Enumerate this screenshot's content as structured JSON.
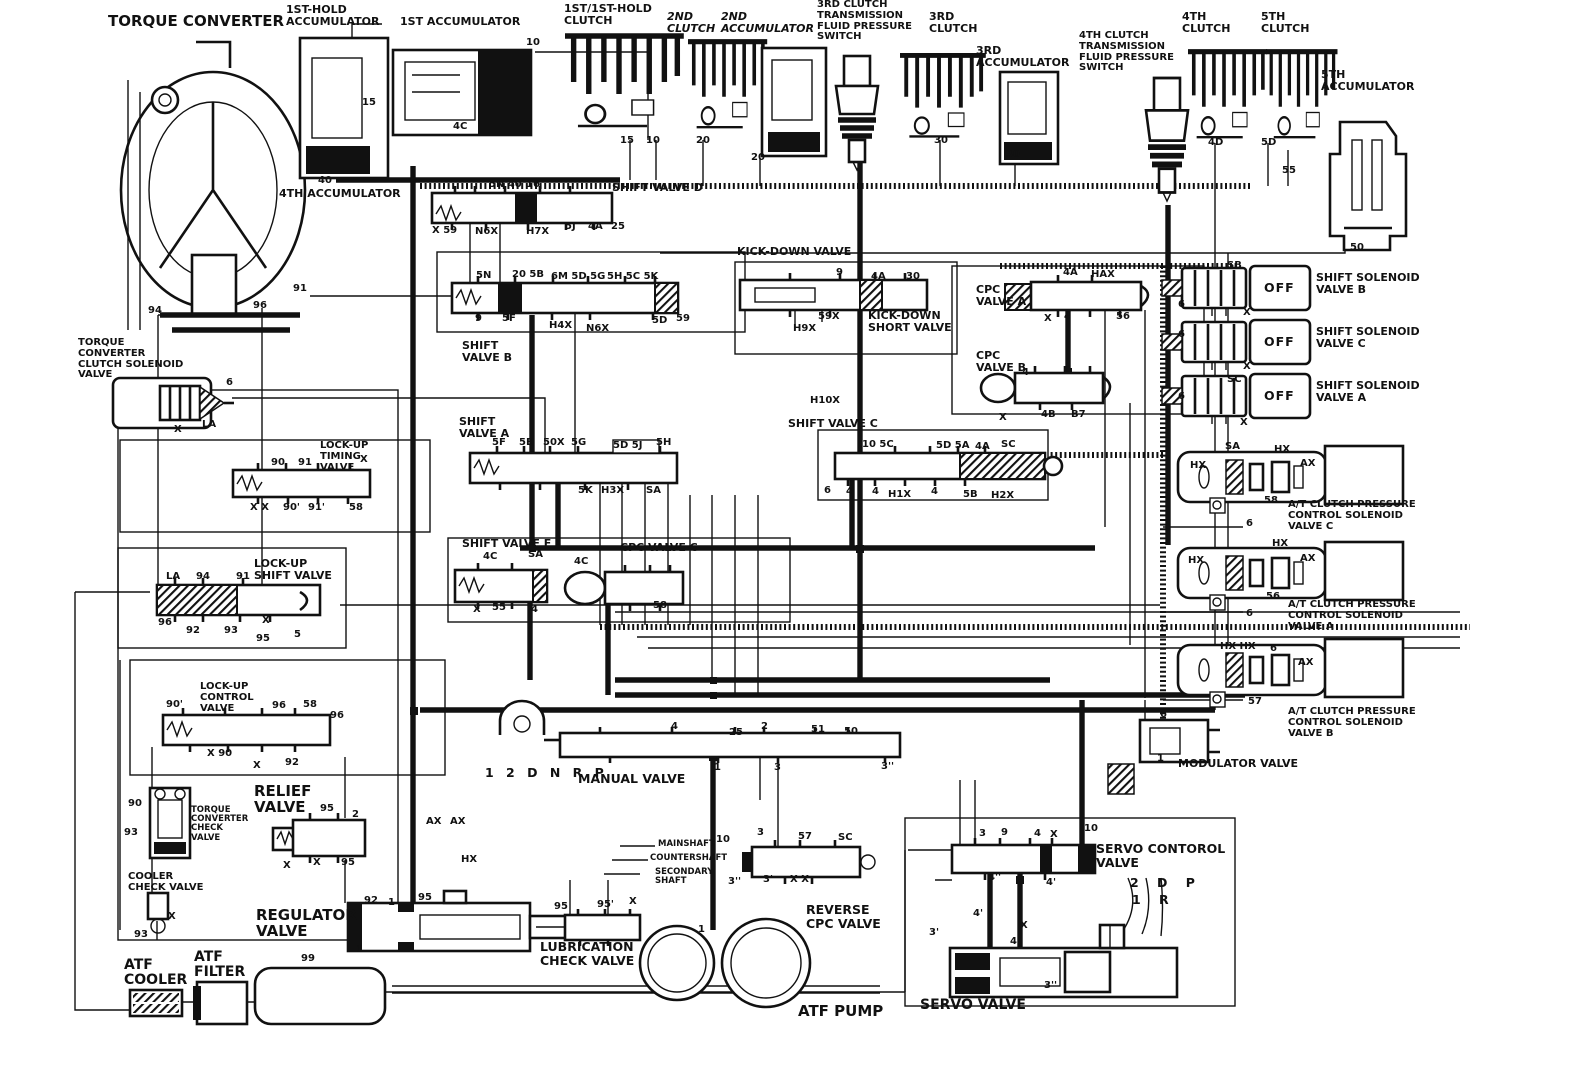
{
  "colors": {
    "ink": "#111111",
    "paper": "#ffffff"
  },
  "labels": {
    "torque_converter": "TORQUE CONVERTER",
    "first_hold_accumulator": "1ST-HOLD\nACCUMULATOR",
    "first_accumulator": "1ST ACCUMULATOR",
    "fourth_accumulator": "4TH ACCUMULATOR",
    "first_first_hold_clutch": "1ST/1ST-HOLD\nCLUTCH",
    "second_clutch": "2ND\nCLUTCH",
    "second_accumulator": "2ND\nACCUMULATOR",
    "third_clutch_switch": "3RD CLUTCH\nTRANSMISSION\nFLUID PRESSURE\nSWITCH",
    "third_clutch": "3RD\nCLUTCH",
    "third_accumulator": "3RD\nACCUMULATOR",
    "fourth_clutch_switch": "4TH CLUTCH\nTRANSMISSION\nFLUID PRESSURE\nSWITCH",
    "fourth_clutch": "4TH\nCLUTCH",
    "fifth_clutch": "5TH\nCLUTCH",
    "fifth_accumulator": "5TH\nACCUMULATOR",
    "shift_valve_d": "SHIFT VALVE D",
    "kick_down_valve": "KICK-DOWN VALVE",
    "kick_down_short_valve": "KICK-DOWN\nSHORT VALVE",
    "cpc_valve_a": "CPC\nVALVE A",
    "cpc_valve_b": "CPC\nVALVE B",
    "cpc_valve_c": "CPC VALVE C",
    "shift_valve_b": "SHIFT\nVALVE B",
    "shift_valve_a": "SHIFT\nVALVE A",
    "shift_valve_c": "SHIFT VALVE C",
    "shift_valve_e": "SHIFT VALVE E",
    "shift_solenoid_b": "SHIFT SOLENOID\nVALVE B",
    "shift_solenoid_c": "SHIFT SOLENOID\nVALVE C",
    "shift_solenoid_a": "SHIFT SOLENOID\nVALVE A",
    "at_cpcs_c": "A/T CLUTCH PRESSURE\nCONTROL SOLENOID\nVALVE C",
    "at_cpcs_a": "A/T CLUTCH PRESSURE\nCONTROL SOLENOID\nVALVE A",
    "at_cpcs_b": "A/T CLUTCH PRESSURE\nCONTROL SOLENOID\nVALVE B",
    "modulator_valve": "MODULATOR VALVE",
    "tcc_solenoid_valve": "TORQUE\nCONVERTER\nCLUTCH SOLENOID\nVALVE",
    "lockup_timing_valve": "LOCK-UP\nTIMING\nVALVE",
    "lockup_shift_valve": "LOCK-UP\nSHIFT VALVE",
    "lockup_control_valve": "LOCK-UP\nCONTROL\nVALVE",
    "tc_check_valve": "TORQUE\nCONVERTER\nCHECK\nVALVE",
    "cooler_check_valve": "COOLER\nCHECK VALVE",
    "relief_valve": "RELIEF\nVALVE",
    "regulator_valve": "REGULATOR\nVALVE",
    "atf_cooler": "ATF\nCOOLER",
    "atf_filter": "ATF\nFILTER",
    "manual_valve": "MANUAL VALVE",
    "manual_positions": "1 2 D N R   P",
    "mainshaft": "MAINSHAFT",
    "countershaft": "COUNTERSHAFT",
    "secondary_shaft": "SECONDARY\nSHAFT",
    "lubrication_check_valve": "LUBRICATION\nCHECK VALVE",
    "atf_pump": "ATF PUMP",
    "reverse_cpc_valve": "REVERSE\nCPC VALVE",
    "servo_control_valve": "SERVO CONTOROL\nVALVE",
    "servo_valve": "SERVO VALVE",
    "servo_pos_top": "2 D  P",
    "servo_pos_bottom": "1      R"
  },
  "ports": [
    {
      "t": "10",
      "x": 526,
      "y": 38
    },
    {
      "t": "15",
      "x": 362,
      "y": 98
    },
    {
      "t": "40",
      "x": 318,
      "y": 176
    },
    {
      "t": "4C",
      "x": 453,
      "y": 122
    },
    {
      "t": "15",
      "x": 620,
      "y": 136
    },
    {
      "t": "10",
      "x": 646,
      "y": 136
    },
    {
      "t": "20",
      "x": 696,
      "y": 136
    },
    {
      "t": "20",
      "x": 751,
      "y": 153
    },
    {
      "t": "30",
      "x": 934,
      "y": 136
    },
    {
      "t": "30",
      "x": 1006,
      "y": 150
    },
    {
      "t": "4D",
      "x": 1208,
      "y": 138
    },
    {
      "t": "5D",
      "x": 1261,
      "y": 138
    },
    {
      "t": "55",
      "x": 1282,
      "y": 166
    },
    {
      "t": "50",
      "x": 1350,
      "y": 243
    },
    {
      "t": "5N 40",
      "x": 489,
      "y": 180
    },
    {
      "t": "16",
      "x": 526,
      "y": 180
    },
    {
      "t": "X 59",
      "x": 432,
      "y": 226
    },
    {
      "t": "N6X",
      "x": 475,
      "y": 227
    },
    {
      "t": "H7X",
      "x": 526,
      "y": 227
    },
    {
      "t": "5J",
      "x": 565,
      "y": 222
    },
    {
      "t": "4A",
      "x": 588,
      "y": 222
    },
    {
      "t": "25",
      "x": 611,
      "y": 222
    },
    {
      "t": "5N",
      "x": 476,
      "y": 271
    },
    {
      "t": "20 5B",
      "x": 512,
      "y": 270
    },
    {
      "t": "6M 5D 5G",
      "x": 551,
      "y": 272
    },
    {
      "t": "5H 5C 5K",
      "x": 607,
      "y": 272
    },
    {
      "t": "9",
      "x": 475,
      "y": 314
    },
    {
      "t": "5F",
      "x": 502,
      "y": 314
    },
    {
      "t": "H4X",
      "x": 549,
      "y": 321
    },
    {
      "t": "N6X",
      "x": 586,
      "y": 324
    },
    {
      "t": "5D",
      "x": 652,
      "y": 316
    },
    {
      "t": "59",
      "x": 676,
      "y": 314
    },
    {
      "t": "5F",
      "x": 492,
      "y": 438
    },
    {
      "t": "5E",
      "x": 519,
      "y": 438
    },
    {
      "t": "50X",
      "x": 543,
      "y": 438
    },
    {
      "t": "5G",
      "x": 571,
      "y": 438
    },
    {
      "t": "5D 5J",
      "x": 613,
      "y": 441
    },
    {
      "t": "5H",
      "x": 656,
      "y": 438
    },
    {
      "t": "5K",
      "x": 578,
      "y": 486
    },
    {
      "t": "H3X",
      "x": 601,
      "y": 486
    },
    {
      "t": "SA",
      "x": 646,
      "y": 486
    },
    {
      "t": "9",
      "x": 836,
      "y": 268
    },
    {
      "t": "4A",
      "x": 871,
      "y": 272
    },
    {
      "t": "30",
      "x": 906,
      "y": 272
    },
    {
      "t": "59X",
      "x": 818,
      "y": 312
    },
    {
      "t": "H9X",
      "x": 793,
      "y": 324
    },
    {
      "t": "H10X",
      "x": 810,
      "y": 396
    },
    {
      "t": "4A",
      "x": 1063,
      "y": 268
    },
    {
      "t": "HAX",
      "x": 1091,
      "y": 270
    },
    {
      "t": "X",
      "x": 1044,
      "y": 314
    },
    {
      "t": "4",
      "x": 1064,
      "y": 312
    },
    {
      "t": "56",
      "x": 1116,
      "y": 312
    },
    {
      "t": "4",
      "x": 1022,
      "y": 368
    },
    {
      "t": "X",
      "x": 999,
      "y": 413
    },
    {
      "t": "4B",
      "x": 1041,
      "y": 410
    },
    {
      "t": "B7",
      "x": 1071,
      "y": 410
    },
    {
      "t": "10 5C",
      "x": 862,
      "y": 440
    },
    {
      "t": "5D 5A",
      "x": 936,
      "y": 441
    },
    {
      "t": "4A",
      "x": 975,
      "y": 442
    },
    {
      "t": "SC",
      "x": 1001,
      "y": 440
    },
    {
      "t": "6",
      "x": 824,
      "y": 486
    },
    {
      "t": "4",
      "x": 846,
      "y": 487
    },
    {
      "t": "4",
      "x": 872,
      "y": 487
    },
    {
      "t": "H1X",
      "x": 888,
      "y": 490
    },
    {
      "t": "4",
      "x": 931,
      "y": 487
    },
    {
      "t": "5B",
      "x": 963,
      "y": 490
    },
    {
      "t": "H2X",
      "x": 991,
      "y": 491
    },
    {
      "t": "4C",
      "x": 483,
      "y": 552
    },
    {
      "t": "SA",
      "x": 528,
      "y": 550
    },
    {
      "t": "X",
      "x": 473,
      "y": 605
    },
    {
      "t": "55",
      "x": 492,
      "y": 603
    },
    {
      "t": "4",
      "x": 531,
      "y": 605
    },
    {
      "t": "4C",
      "x": 574,
      "y": 557
    },
    {
      "t": "58",
      "x": 653,
      "y": 601
    },
    {
      "t": "SB",
      "x": 1227,
      "y": 261
    },
    {
      "t": "6",
      "x": 1178,
      "y": 300
    },
    {
      "t": "X",
      "x": 1243,
      "y": 308
    },
    {
      "t": "OFF",
      "x": 1264,
      "y": 282,
      "c": "off"
    },
    {
      "t": "OFF",
      "x": 1264,
      "y": 336,
      "c": "off"
    },
    {
      "t": "OFF",
      "x": 1264,
      "y": 390,
      "c": "off"
    },
    {
      "t": "6",
      "x": 1178,
      "y": 330
    },
    {
      "t": "X",
      "x": 1243,
      "y": 362
    },
    {
      "t": "SC",
      "x": 1227,
      "y": 375
    },
    {
      "t": "6",
      "x": 1178,
      "y": 392
    },
    {
      "t": "X",
      "x": 1240,
      "y": 418
    },
    {
      "t": "SA",
      "x": 1225,
      "y": 442
    },
    {
      "t": "HX",
      "x": 1274,
      "y": 445
    },
    {
      "t": "HX",
      "x": 1190,
      "y": 461
    },
    {
      "t": "AX",
      "x": 1300,
      "y": 459
    },
    {
      "t": "58",
      "x": 1264,
      "y": 496
    },
    {
      "t": "6",
      "x": 1246,
      "y": 519
    },
    {
      "t": "HX",
      "x": 1272,
      "y": 539
    },
    {
      "t": "HX",
      "x": 1188,
      "y": 556
    },
    {
      "t": "AX",
      "x": 1300,
      "y": 554
    },
    {
      "t": "56",
      "x": 1266,
      "y": 592
    },
    {
      "t": "6",
      "x": 1246,
      "y": 609
    },
    {
      "t": "HX HX",
      "x": 1220,
      "y": 642
    },
    {
      "t": "6",
      "x": 1270,
      "y": 644
    },
    {
      "t": "AX",
      "x": 1298,
      "y": 658
    },
    {
      "t": "57",
      "x": 1248,
      "y": 697
    },
    {
      "t": "6",
      "x": 1160,
      "y": 710
    },
    {
      "t": "1",
      "x": 1157,
      "y": 754
    },
    {
      "t": "94",
      "x": 148,
      "y": 306
    },
    {
      "t": "96",
      "x": 253,
      "y": 301
    },
    {
      "t": "91",
      "x": 293,
      "y": 284
    },
    {
      "t": "6",
      "x": 226,
      "y": 378
    },
    {
      "t": "X",
      "x": 174,
      "y": 425
    },
    {
      "t": "LA",
      "x": 202,
      "y": 420
    },
    {
      "t": "90",
      "x": 271,
      "y": 458
    },
    {
      "t": "91",
      "x": 298,
      "y": 458
    },
    {
      "t": "X",
      "x": 360,
      "y": 455
    },
    {
      "t": "X X",
      "x": 250,
      "y": 503
    },
    {
      "t": "90'",
      "x": 283,
      "y": 503
    },
    {
      "t": "91'",
      "x": 308,
      "y": 503
    },
    {
      "t": "58",
      "x": 349,
      "y": 503
    },
    {
      "t": "LA",
      "x": 166,
      "y": 572
    },
    {
      "t": "94",
      "x": 196,
      "y": 572
    },
    {
      "t": "91",
      "x": 236,
      "y": 572
    },
    {
      "t": "96",
      "x": 158,
      "y": 618
    },
    {
      "t": "92",
      "x": 186,
      "y": 626
    },
    {
      "t": "93",
      "x": 224,
      "y": 626
    },
    {
      "t": "X",
      "x": 262,
      "y": 616
    },
    {
      "t": "95",
      "x": 256,
      "y": 634
    },
    {
      "t": "5",
      "x": 294,
      "y": 630
    },
    {
      "t": "90'",
      "x": 166,
      "y": 700
    },
    {
      "t": "96",
      "x": 272,
      "y": 701
    },
    {
      "t": "58",
      "x": 303,
      "y": 700
    },
    {
      "t": "96",
      "x": 330,
      "y": 711
    },
    {
      "t": "X 90",
      "x": 207,
      "y": 749
    },
    {
      "t": "X",
      "x": 253,
      "y": 761
    },
    {
      "t": "92",
      "x": 285,
      "y": 758
    },
    {
      "t": "90",
      "x": 128,
      "y": 799
    },
    {
      "t": "93",
      "x": 124,
      "y": 828
    },
    {
      "t": "93",
      "x": 134,
      "y": 930
    },
    {
      "t": "X",
      "x": 168,
      "y": 912
    },
    {
      "t": "95",
      "x": 320,
      "y": 804
    },
    {
      "t": "2",
      "x": 352,
      "y": 810
    },
    {
      "t": "X",
      "x": 283,
      "y": 861
    },
    {
      "t": "X",
      "x": 313,
      "y": 858
    },
    {
      "t": "95",
      "x": 341,
      "y": 858
    },
    {
      "t": "AX",
      "x": 426,
      "y": 817
    },
    {
      "t": "AX",
      "x": 450,
      "y": 817
    },
    {
      "t": "HX",
      "x": 461,
      "y": 855
    },
    {
      "t": "92",
      "x": 364,
      "y": 896
    },
    {
      "t": "1",
      "x": 388,
      "y": 898
    },
    {
      "t": "95",
      "x": 418,
      "y": 893
    },
    {
      "t": "1",
      "x": 356,
      "y": 945
    },
    {
      "t": "99",
      "x": 301,
      "y": 954
    },
    {
      "t": "95",
      "x": 554,
      "y": 902
    },
    {
      "t": "95'",
      "x": 597,
      "y": 900
    },
    {
      "t": "X",
      "x": 629,
      "y": 897
    },
    {
      "t": "1",
      "x": 698,
      "y": 925
    },
    {
      "t": "4",
      "x": 671,
      "y": 722
    },
    {
      "t": "25",
      "x": 729,
      "y": 728
    },
    {
      "t": "2",
      "x": 761,
      "y": 722
    },
    {
      "t": "51",
      "x": 811,
      "y": 725
    },
    {
      "t": "50",
      "x": 844,
      "y": 727
    },
    {
      "t": "1",
      "x": 714,
      "y": 763
    },
    {
      "t": "3",
      "x": 774,
      "y": 763
    },
    {
      "t": "3''",
      "x": 881,
      "y": 762
    },
    {
      "t": "10",
      "x": 716,
      "y": 835
    },
    {
      "t": "3",
      "x": 757,
      "y": 828
    },
    {
      "t": "57",
      "x": 798,
      "y": 832
    },
    {
      "t": "SC",
      "x": 838,
      "y": 833
    },
    {
      "t": "3''",
      "x": 728,
      "y": 877
    },
    {
      "t": "3'",
      "x": 763,
      "y": 875
    },
    {
      "t": "X X",
      "x": 790,
      "y": 875
    },
    {
      "t": "3",
      "x": 979,
      "y": 829
    },
    {
      "t": "9",
      "x": 1001,
      "y": 828
    },
    {
      "t": "4",
      "x": 1034,
      "y": 829
    },
    {
      "t": "X",
      "x": 1050,
      "y": 830
    },
    {
      "t": "10",
      "x": 1084,
      "y": 824
    },
    {
      "t": "4''",
      "x": 988,
      "y": 873
    },
    {
      "t": "4'",
      "x": 1046,
      "y": 878
    },
    {
      "t": "4'",
      "x": 973,
      "y": 909
    },
    {
      "t": "3'",
      "x": 929,
      "y": 928
    },
    {
      "t": "X",
      "x": 1020,
      "y": 921
    },
    {
      "t": "4''",
      "x": 1010,
      "y": 937
    },
    {
      "t": "3''",
      "x": 1044,
      "y": 981
    }
  ]
}
